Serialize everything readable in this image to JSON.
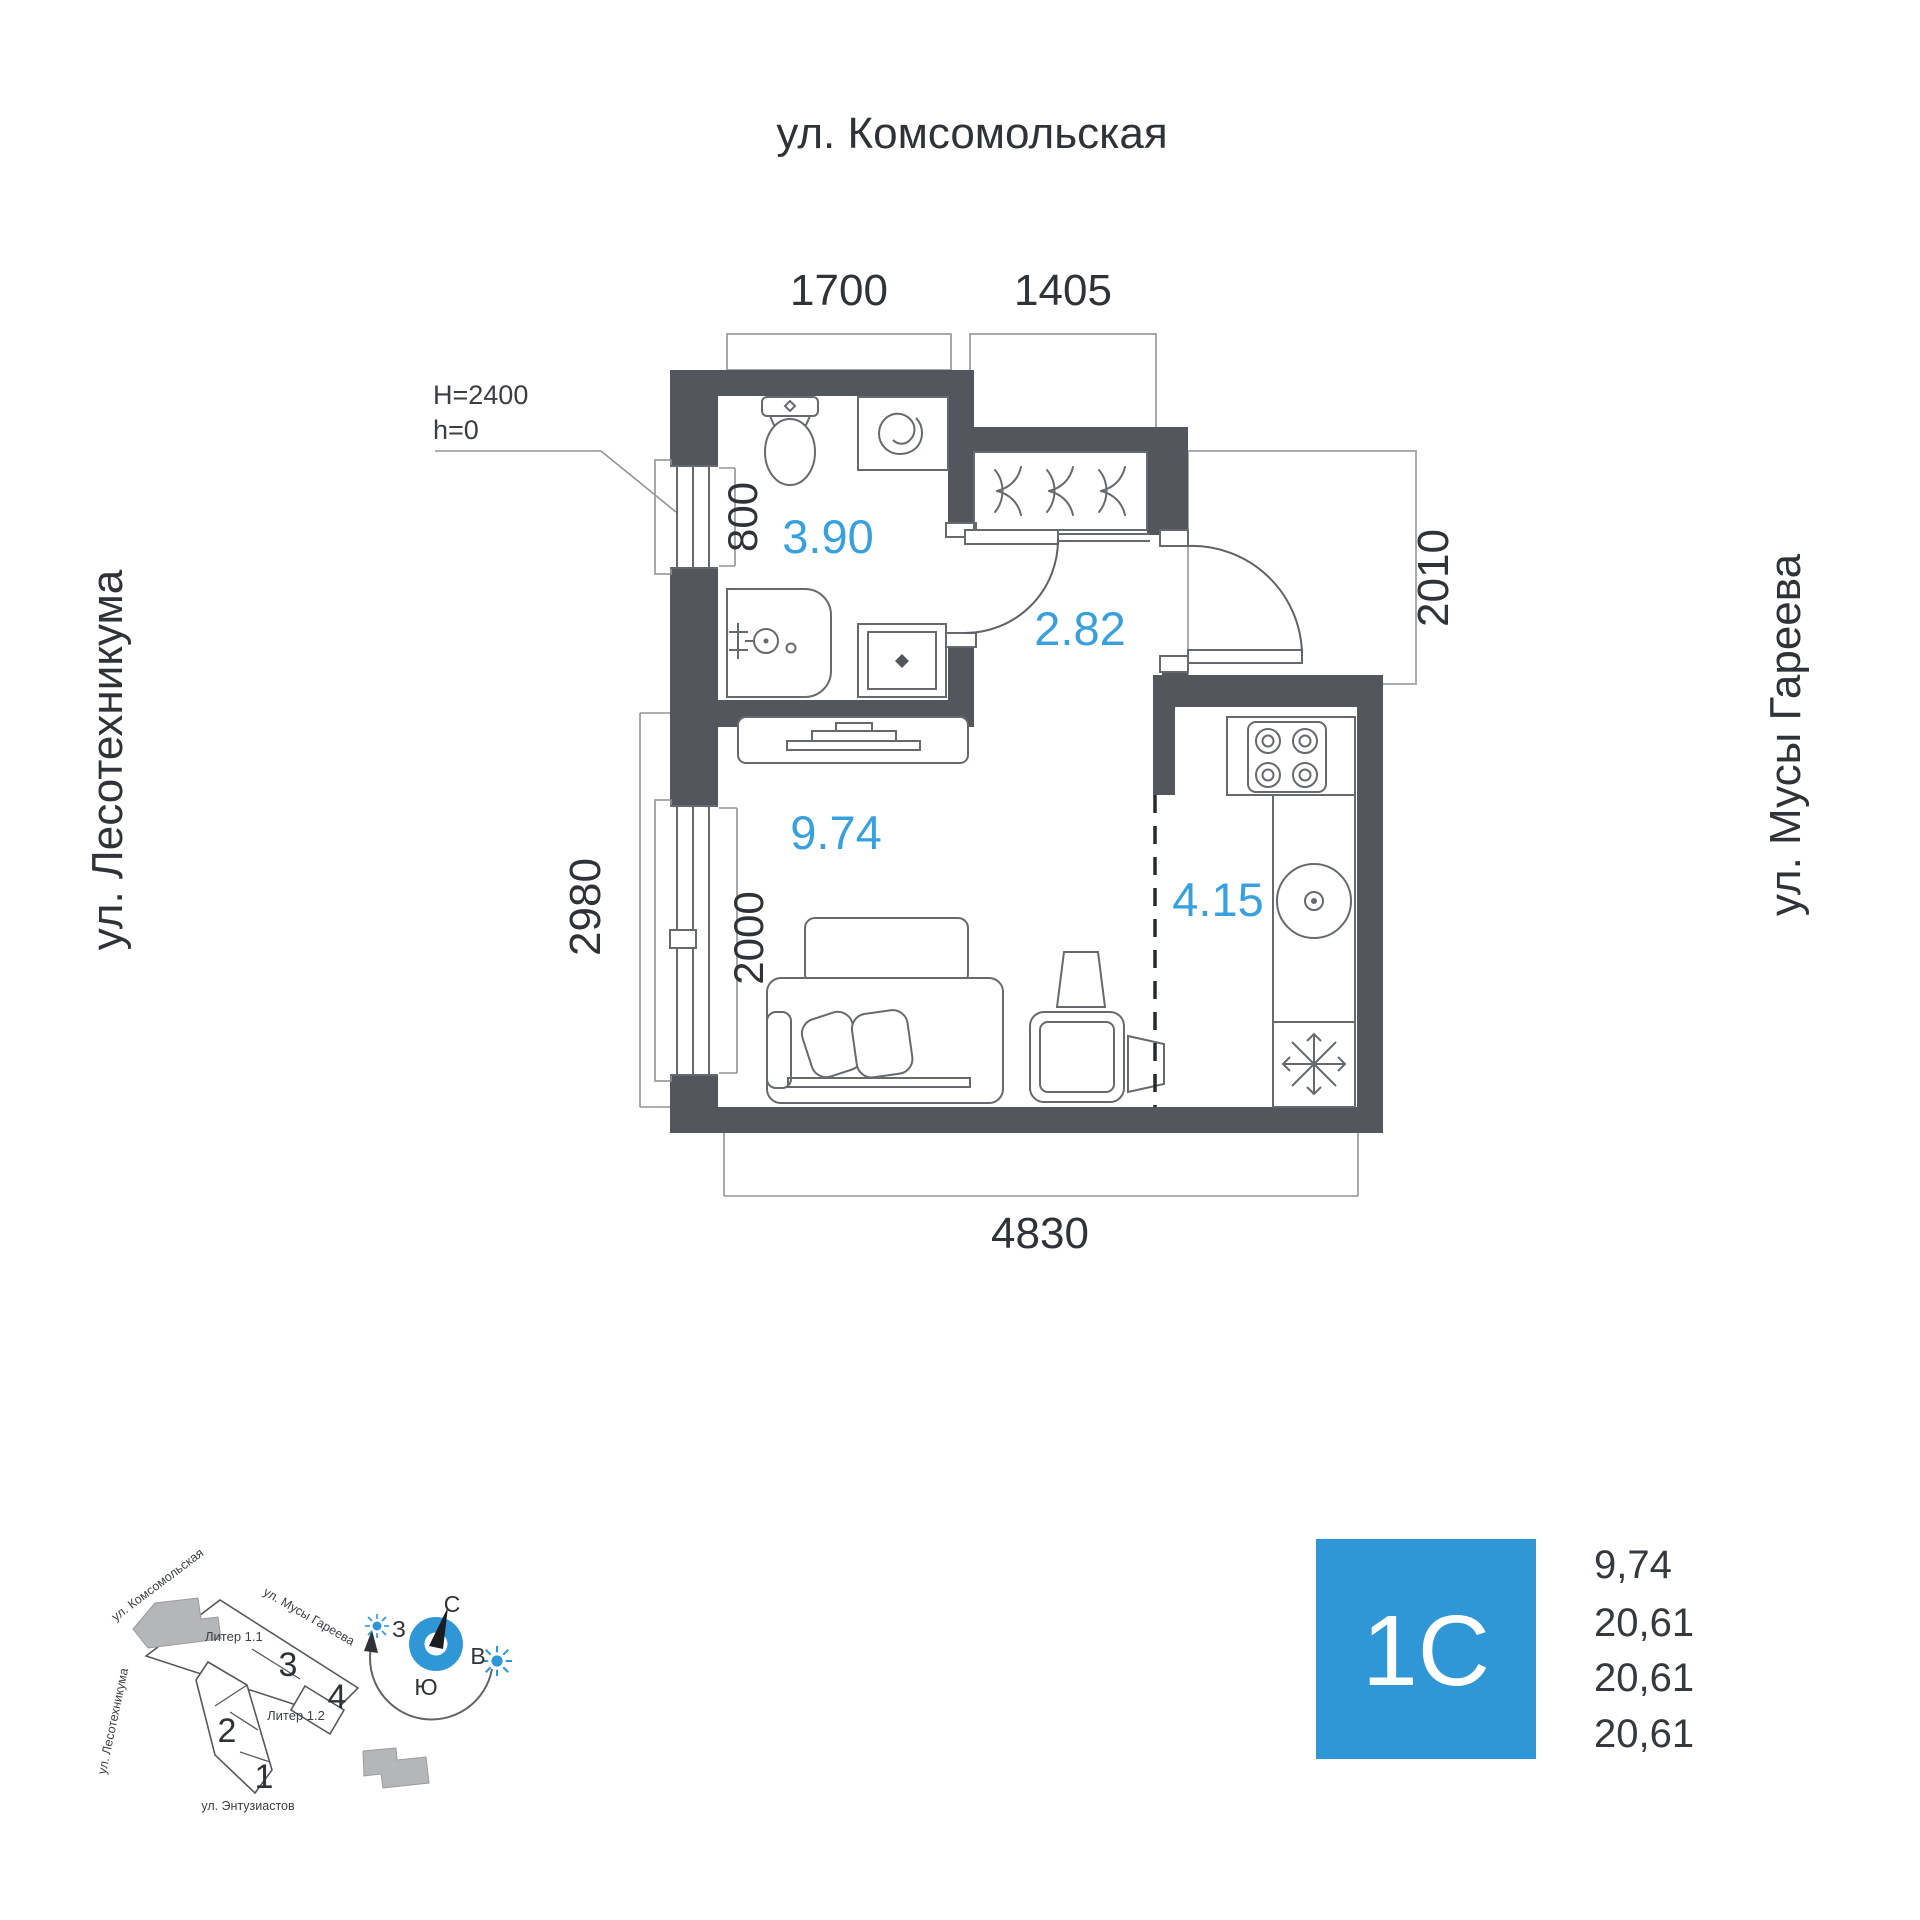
{
  "plan": {
    "street_top": "ул. Комсомольская",
    "street_left": "ул. Лесотехникума",
    "street_right": "ул. Мусы Гареева",
    "height_note_line1": "H=2400",
    "height_note_line2": "h=0",
    "dims": {
      "top_bath": "1700",
      "top_hall": "1405",
      "bath_window": "800",
      "left_total": "2980",
      "living_window": "2000",
      "landing": "2010",
      "bottom": "4830"
    },
    "areas": {
      "bathroom": "3.90",
      "hallway": "2.82",
      "living": "9.74",
      "kitchen": "4.15"
    }
  },
  "minimap": {
    "street_komsomolskaya": "ул. Комсомольская",
    "street_musy_gareeva": "ул. Мусы Гареева",
    "street_lesotehnikuma": "ул. Лесотехникума",
    "street_entuziastov": "ул. Энтузиастов",
    "building_1": "Литер 1.1",
    "building_2": "Литер 1.2",
    "sections": [
      "1",
      "2",
      "3",
      "4"
    ],
    "compass": {
      "n": "С",
      "s": "Ю",
      "w": "З",
      "e": "В"
    }
  },
  "info": {
    "unit_label": "1С",
    "area_values": [
      "9,74",
      "20,61",
      "20,61",
      "20,61"
    ]
  },
  "colors": {
    "accent_blue": "#2f97d5",
    "area_blue": "#38a1dd",
    "wall_gray": "#53565c",
    "text_dark": "#2f3237"
  }
}
